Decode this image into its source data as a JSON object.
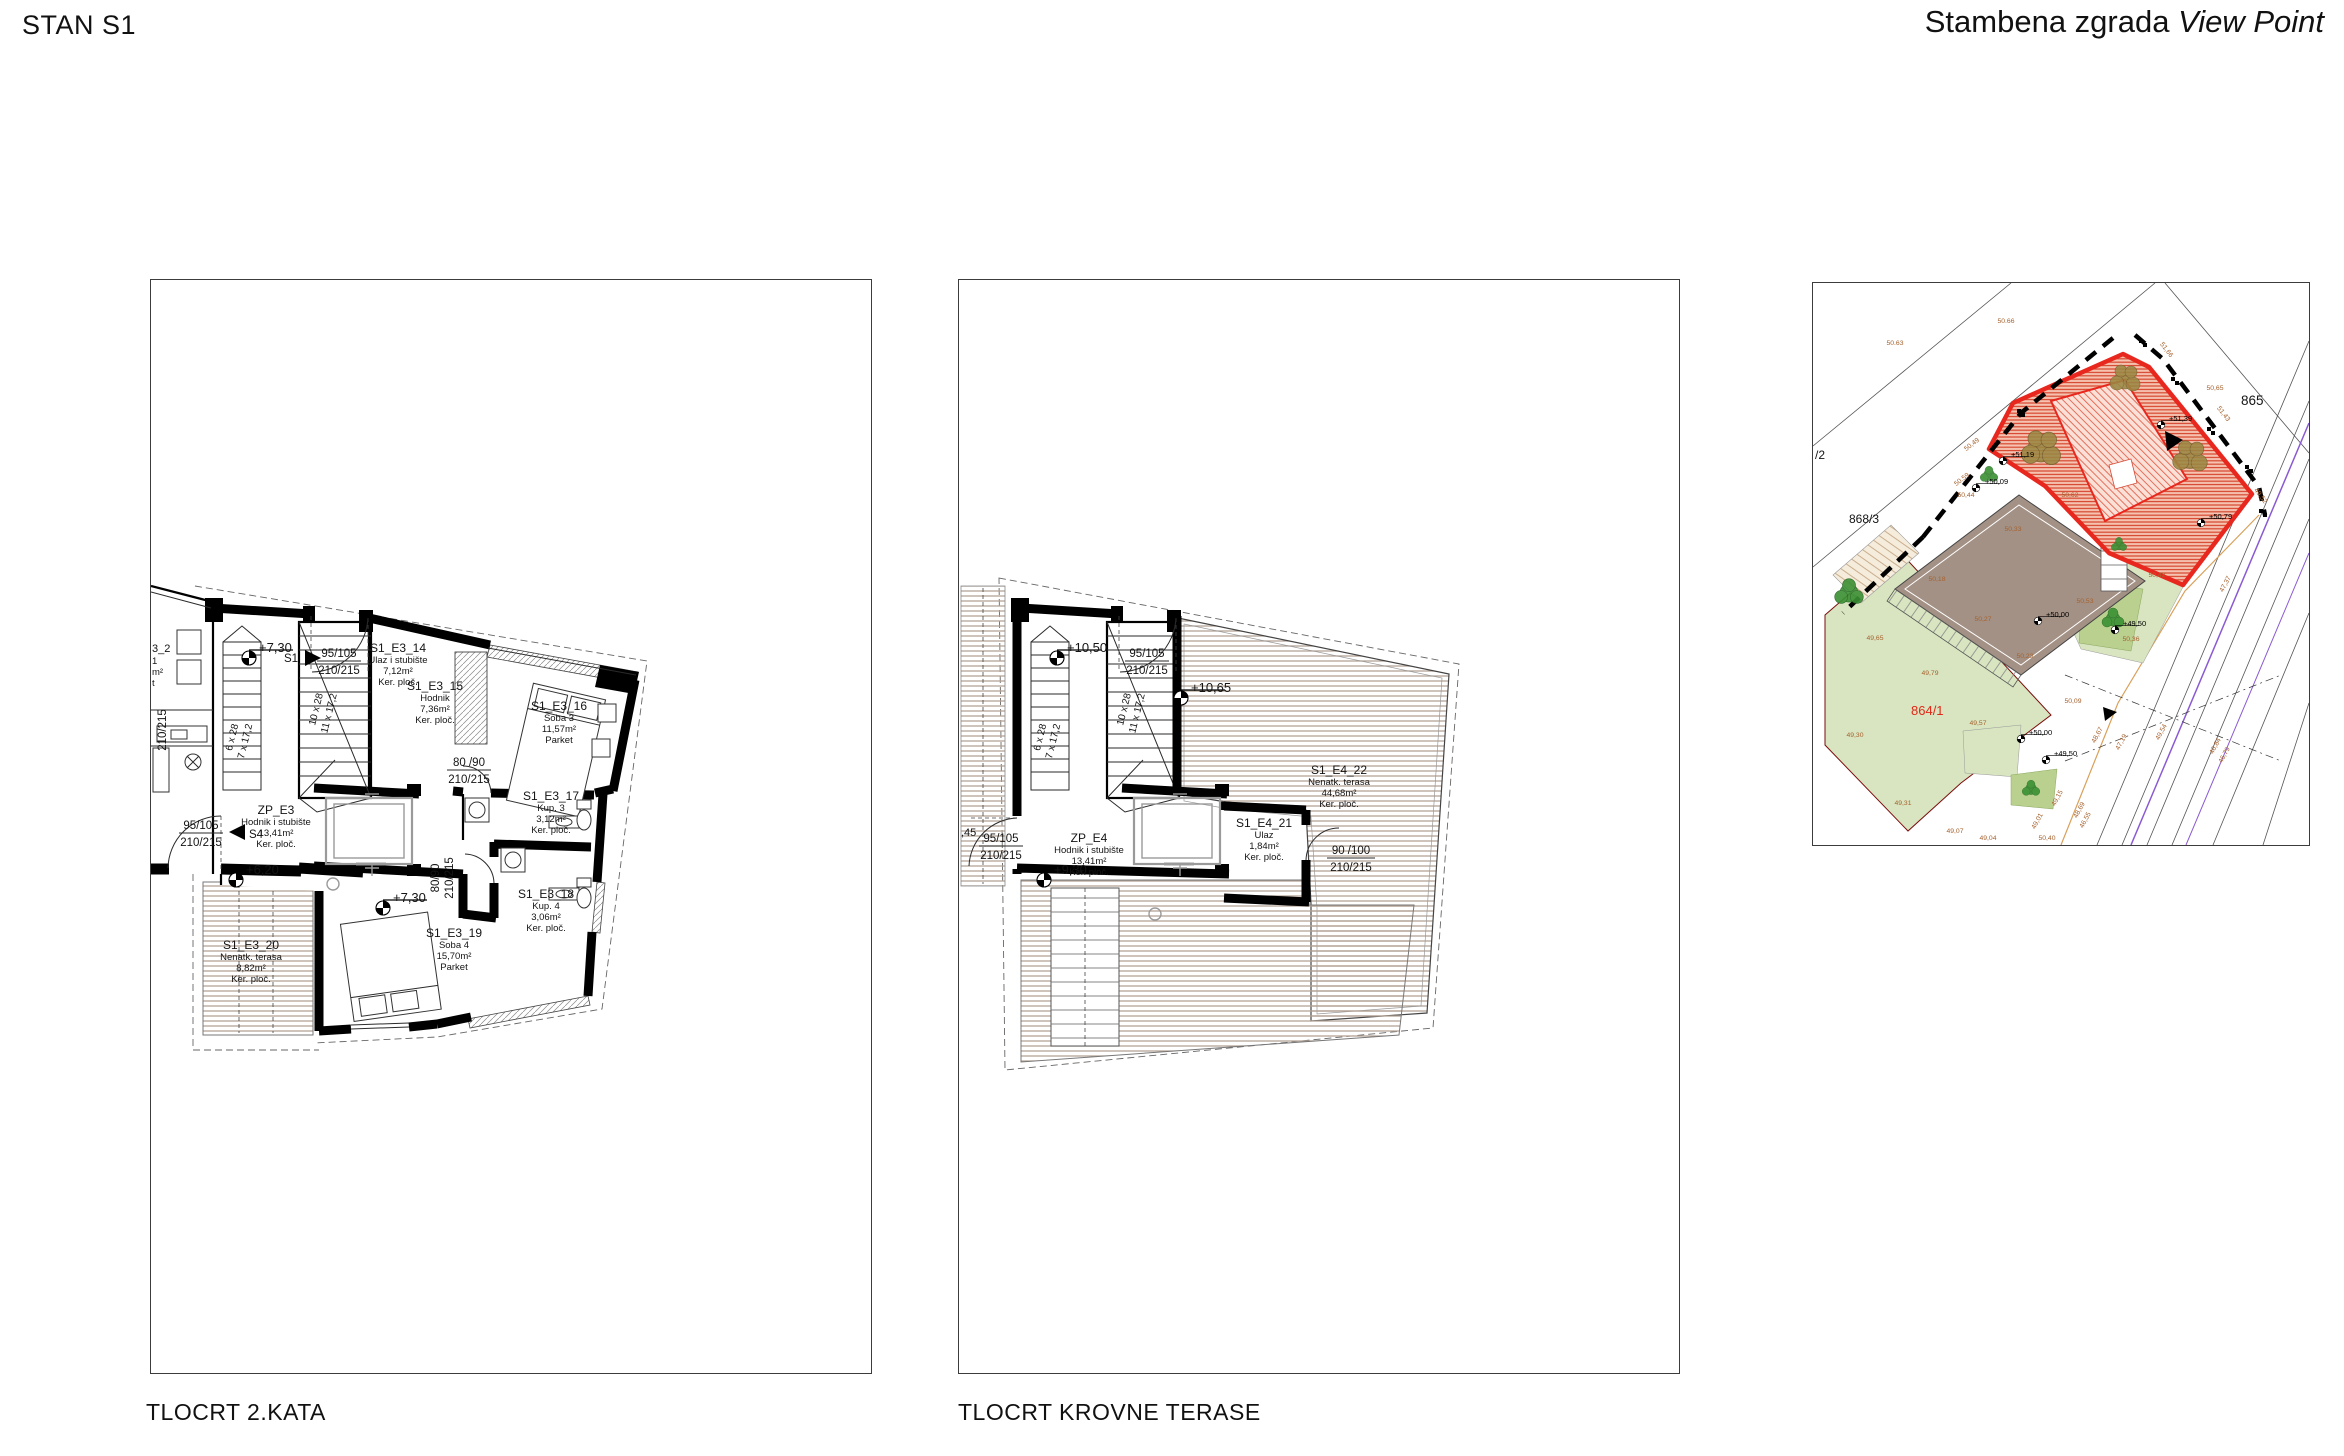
{
  "header": {
    "left": "STAN S1",
    "project": "Stambena zgrada",
    "project_name": "View Point"
  },
  "captions": {
    "plan1": "TLOCRT 2.KATA",
    "plan2": "TLOCRT KROVNE TERASE"
  },
  "colors": {
    "highlight_red": "#e8281e",
    "deck_line": "#b3a396",
    "lawn": "#d8e5c0",
    "roof_gray": "#a39185",
    "spot_brown": "#a5622f",
    "road_purple": "#8a5ad2"
  },
  "stairs": {
    "f1a": "6 x 28",
    "f1b": "7 x 17,2",
    "f2a": "10 x 28",
    "f2b": "11 x 17,2"
  },
  "plan1": {
    "rooms": [
      {
        "code": "S1_E3_14",
        "name": "Ulaz i stubište",
        "area": "7,12m²",
        "floor": "Ker. ploč."
      },
      {
        "code": "S1_E3_15",
        "name": "Hodnik",
        "area": "7,36m²",
        "floor": "Ker. ploč."
      },
      {
        "code": "S1_E3_16",
        "name": "Soba 3",
        "area": "11,57m²",
        "floor": "Parket"
      },
      {
        "code": "S1_E3_17",
        "name": "Kup. 3",
        "area": "3,12m²",
        "floor": "Ker. ploč."
      },
      {
        "code": "S1_E3_18",
        "name": "Kup. 4",
        "area": "3,06m²",
        "floor": "Ker. ploč."
      },
      {
        "code": "S1_E3_19",
        "name": "Soba 4",
        "area": "15,70m²",
        "floor": "Parket"
      },
      {
        "code": "S1_E3_20",
        "name": "Nenatk. terasa",
        "area": "8,82m²",
        "floor": "Ker. ploč."
      },
      {
        "code": "ZP_E3",
        "name": "Hodnik i stubište",
        "area": "13,41m²",
        "floor": "Ker. ploč."
      }
    ],
    "levels": {
      "top": "+7,30",
      "mid": "+6,20",
      "bottom": "+7,30"
    },
    "doors": {
      "d1a": "95/105",
      "d1b": "210/215",
      "d2a": "95/105",
      "d2b": "210/215",
      "d3a": "80 /90",
      "d3b": "210/215",
      "d4a": "80/90",
      "d4b": "210/215",
      "left": "210/215"
    },
    "markers": {
      "s1": "S1",
      "s4": "S4"
    },
    "fragments": {
      "a": "3_2",
      "b": "1",
      "c": "m²",
      "d": "t"
    }
  },
  "plan2": {
    "rooms": [
      {
        "code": "ZP_E4",
        "name": "Hodnik i stubište",
        "area": "13,41m²",
        "floor": "Ker. ploč."
      },
      {
        "code": "S1_E4_21",
        "name": "Ulaz",
        "area": "1,84m²",
        "floor": "Ker. ploč."
      },
      {
        "code": "S1_E4_22",
        "name": "Nenatk. terasa",
        "area": "44,68m²",
        "floor": "Ker. ploč."
      }
    ],
    "levels": {
      "top": "+10,50",
      "mid": "+10,65",
      "bottom": "+9,30"
    },
    "doors": {
      "d1a": "95/105",
      "d1b": "210/215",
      "d2a": "95/105",
      "d2b": "210/215",
      "d3a": "90 /100",
      "d3b": "210/215"
    },
    "fragments": {
      "a": ",45"
    }
  },
  "site": {
    "parcels": {
      "p865": "865",
      "p868": "868/3",
      "p864": "864/1",
      "p2": "/2"
    },
    "levels": [
      "+50,09",
      "+51,19",
      "+51,39",
      "+50,79",
      "+50,00",
      "+49,50",
      "+50,00",
      "+49,50"
    ],
    "spots": [
      "50.63",
      "50.66",
      "50,65",
      "51,66",
      "51,43",
      "50,49",
      "50,59",
      "50,44",
      "50,33",
      "50,18",
      "50,27",
      "50,23",
      "50,53",
      "50,36",
      "50,62",
      "50,42",
      "50,09",
      "49,65",
      "49,79",
      "49,57",
      "49,30",
      "49,31",
      "49,07",
      "49,04",
      "49,52",
      "50,40",
      "49,54",
      "49,15",
      "48,69",
      "48,67",
      "47,19",
      "46,55",
      "49,01",
      "47,37",
      "46,84",
      "46,79"
    ]
  }
}
